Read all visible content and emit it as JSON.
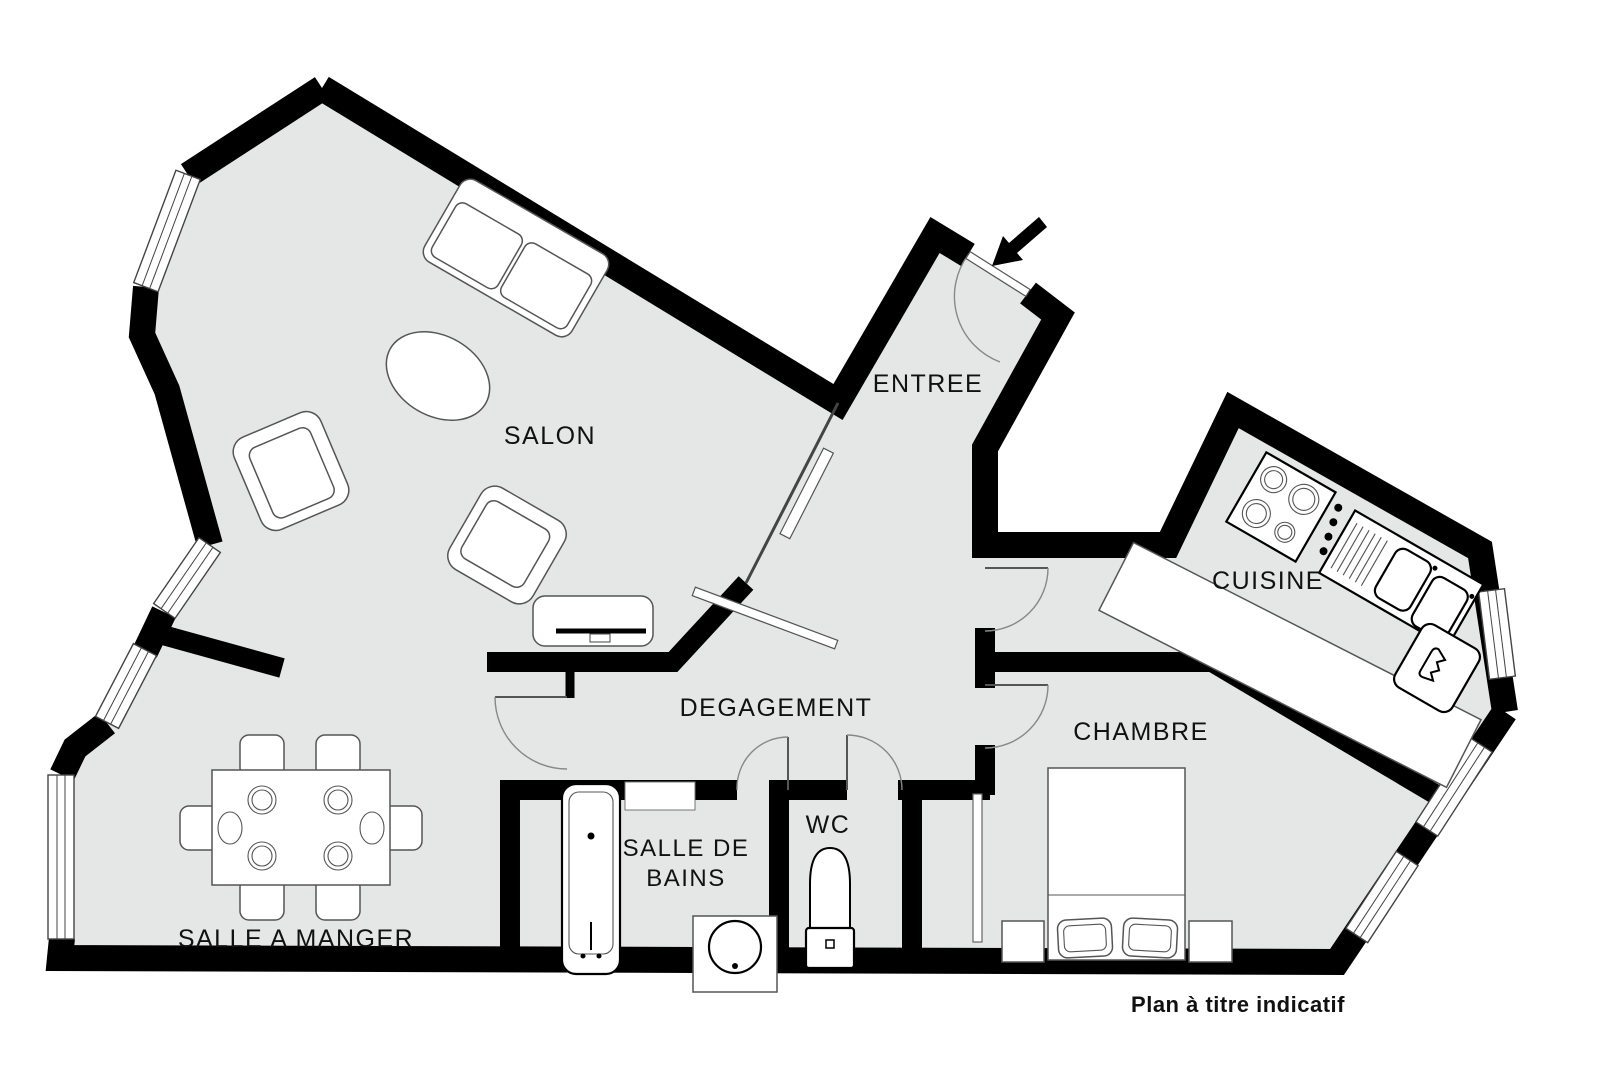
{
  "caption": "Plan à titre indicatif",
  "colors": {
    "background": "#ffffff",
    "floor": "#e5e6e6",
    "wall": "#000000",
    "furniture_outline": "#555555"
  },
  "rooms": {
    "salon": {
      "label": "SALON"
    },
    "entree": {
      "label": "ENTREE"
    },
    "cuisine": {
      "label": "CUISINE"
    },
    "degagement": {
      "label": "DEGAGEMENT"
    },
    "chambre": {
      "label": "CHAMBRE"
    },
    "wc": {
      "label": "WC"
    },
    "salle_de_bains": {
      "label_line1": "SALLE DE",
      "label_line2": "BAINS"
    },
    "salle_a_manger": {
      "label": "SALLE A MANGER"
    }
  },
  "icons": {
    "entrance_arrow": "arrow-pointing-to-entrance-door",
    "sofa": "two-seat-sofa",
    "coffee_table": "oval-coffee-table",
    "armchairs": "two-armchairs",
    "tv_console": "tv-sideboard",
    "dining_table": "table-with-six-chairs",
    "kitchen": "hob-and-double-sink-counter",
    "fridge": "fridge",
    "bed": "double-bed-with-pillows-and-nightstands",
    "bathtub": "bathtub",
    "washbasin": "round-washbasin",
    "toilet": "toilet",
    "doors": "door-swing-arcs",
    "windows": "double-line-windows"
  }
}
